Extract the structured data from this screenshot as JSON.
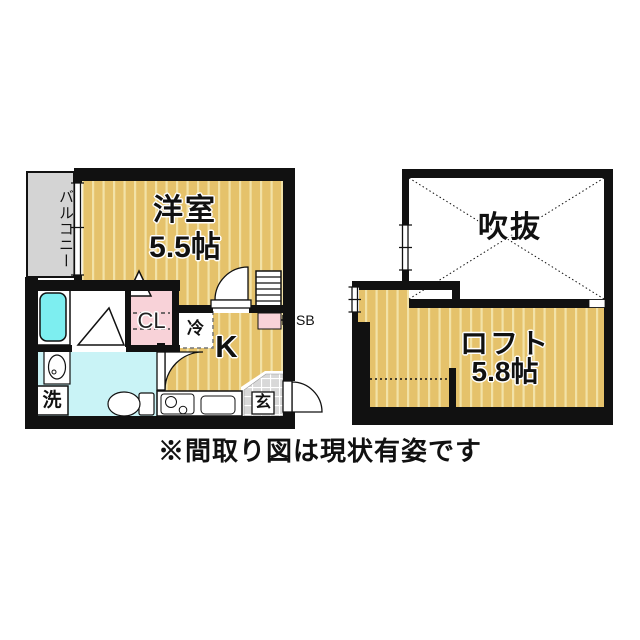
{
  "floor1": {
    "balcony": "バルコニー",
    "room_name": "洋室",
    "room_size": "5.5帖",
    "closet": "CL",
    "refrigerator": "冷",
    "kitchen": "K",
    "shoe_box": "SB",
    "entrance": "玄",
    "laundry": "洗"
  },
  "floor2": {
    "void": "吹抜",
    "loft_name": "ロフト",
    "loft_size": "5.8帖"
  },
  "caption": "※間取り図は現状有姿です",
  "colors": {
    "wall": "#111111",
    "floor_tan": "#e5c26b",
    "floor_stripe": "#f2e2a7",
    "balcony_gray": "#d4d4d4",
    "bath_cyan": "#7deef0",
    "washroom_cyan": "#c9f3f6",
    "closet_pink": "#f8d2d8",
    "entrance_gray": "#d8d8d8"
  }
}
